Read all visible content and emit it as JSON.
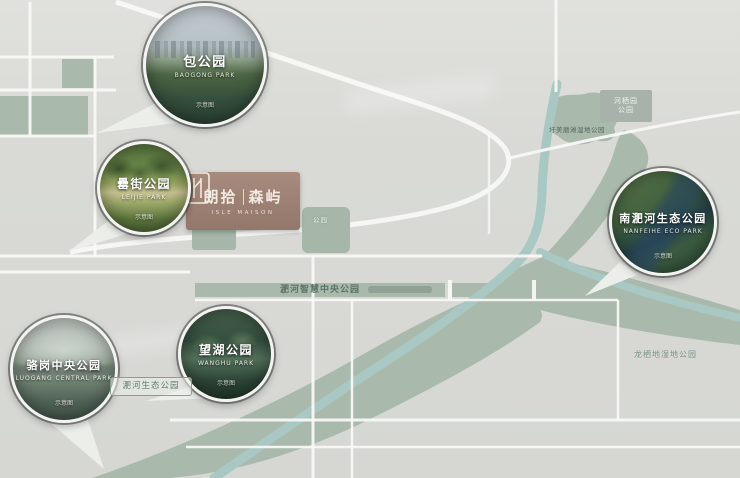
{
  "project": {
    "logo_cn_left": "朗拾",
    "logo_cn_right": "森屿",
    "logo_en": "ISLE MAISON"
  },
  "circles": [
    {
      "name": "包公园",
      "en": "BAOGONG PARK",
      "caption": "示意图"
    },
    {
      "name": "罍街公园",
      "en": "LEIJIE PARK",
      "caption": "示意图"
    },
    {
      "name": "南淝河生态公园",
      "en": "NANFEIHE ECO PARK",
      "caption": "示意图"
    },
    {
      "name": "望湖公园",
      "en": "WANGHU PARK",
      "caption": "示意图"
    },
    {
      "name": "骆岗中央公园",
      "en": "LUOGANG CENTRAL PARK",
      "caption": "示意图"
    }
  ],
  "labels": {
    "feihe_smart_central_park": "淝河智慧中央公园",
    "feihe_eco_park": "淝河生态公园",
    "longqidi_wetland_park": "龙栖地湿地公园",
    "weimei_wetland_park": "圩美磨滩湿地公园",
    "heqiyuan_line1": "河栖园",
    "heqiyuan_line2": "公园",
    "patch_left_park": "公园",
    "patch_right_park": "公园"
  },
  "colors": {
    "background": "#d8d9d5",
    "greenery": "#a9b9ac",
    "river": "#a9c7c3",
    "road": "#f8f8f6",
    "logo_brown": "#9c8072",
    "label_text": "#5b7366"
  }
}
